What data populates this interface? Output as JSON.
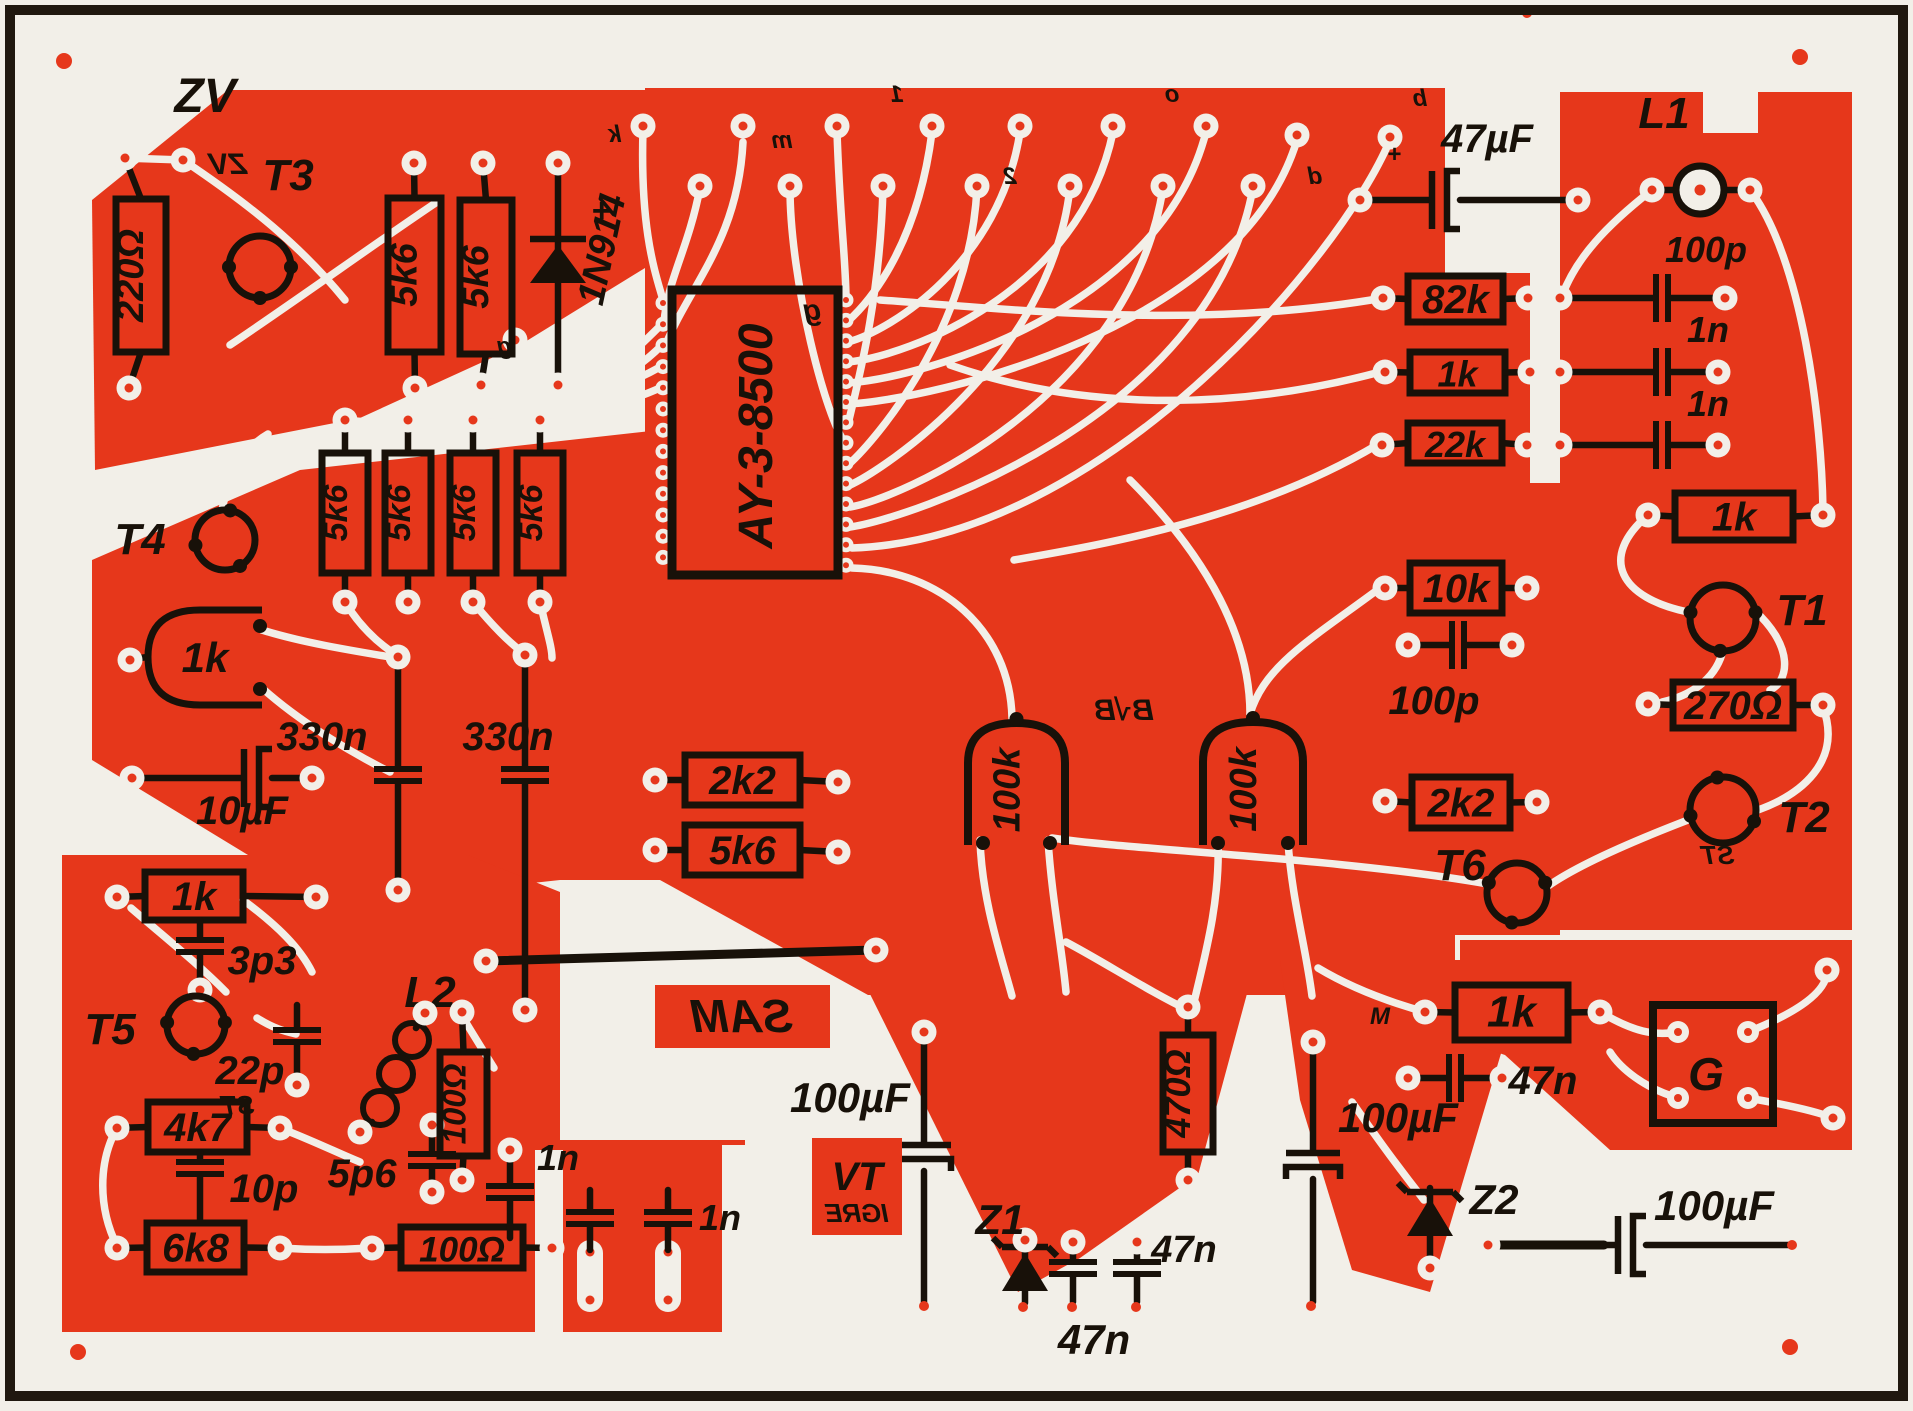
{
  "labels": {
    "zv": "ZV",
    "r220": "220Ω",
    "t3": "T3",
    "r5k6": "5k6",
    "d1": "1N914",
    "plus": "+",
    "ic": "AY-3-8500",
    "icg": "g",
    "c47u": "47µF",
    "l1": "L1",
    "r82k": "82k",
    "c100p": "100p",
    "r1k": "1k",
    "c1n": "1n",
    "r22k": "22k",
    "r10k": "10k",
    "t1": "T1",
    "r270": "270Ω",
    "t2": "T2",
    "r2k2": "2k2",
    "r100k": "100k",
    "t4": "T4",
    "c330n": "330n",
    "c10u": "10µF",
    "t6": "T6",
    "c3p3": "3p3",
    "t5": "T5",
    "c22p": "22p",
    "l2": "L2",
    "r4k7": "4k7",
    "c10p": "10p",
    "c5p6": "5p6",
    "r100": "100Ω",
    "r6k8": "6k8",
    "sam": "SAM",
    "c100u": "100µF",
    "vt": "VT",
    "igre": "IGRE",
    "z1": "Z1",
    "c47n": "47n",
    "r470": "470Ω",
    "z2": "Z2",
    "g": "G",
    "st": "ST",
    "m": "M",
    "bvb": "B√B"
  },
  "pad_letters": [
    "k",
    "m",
    "1",
    "2",
    "o",
    "d",
    "b",
    "+"
  ]
}
